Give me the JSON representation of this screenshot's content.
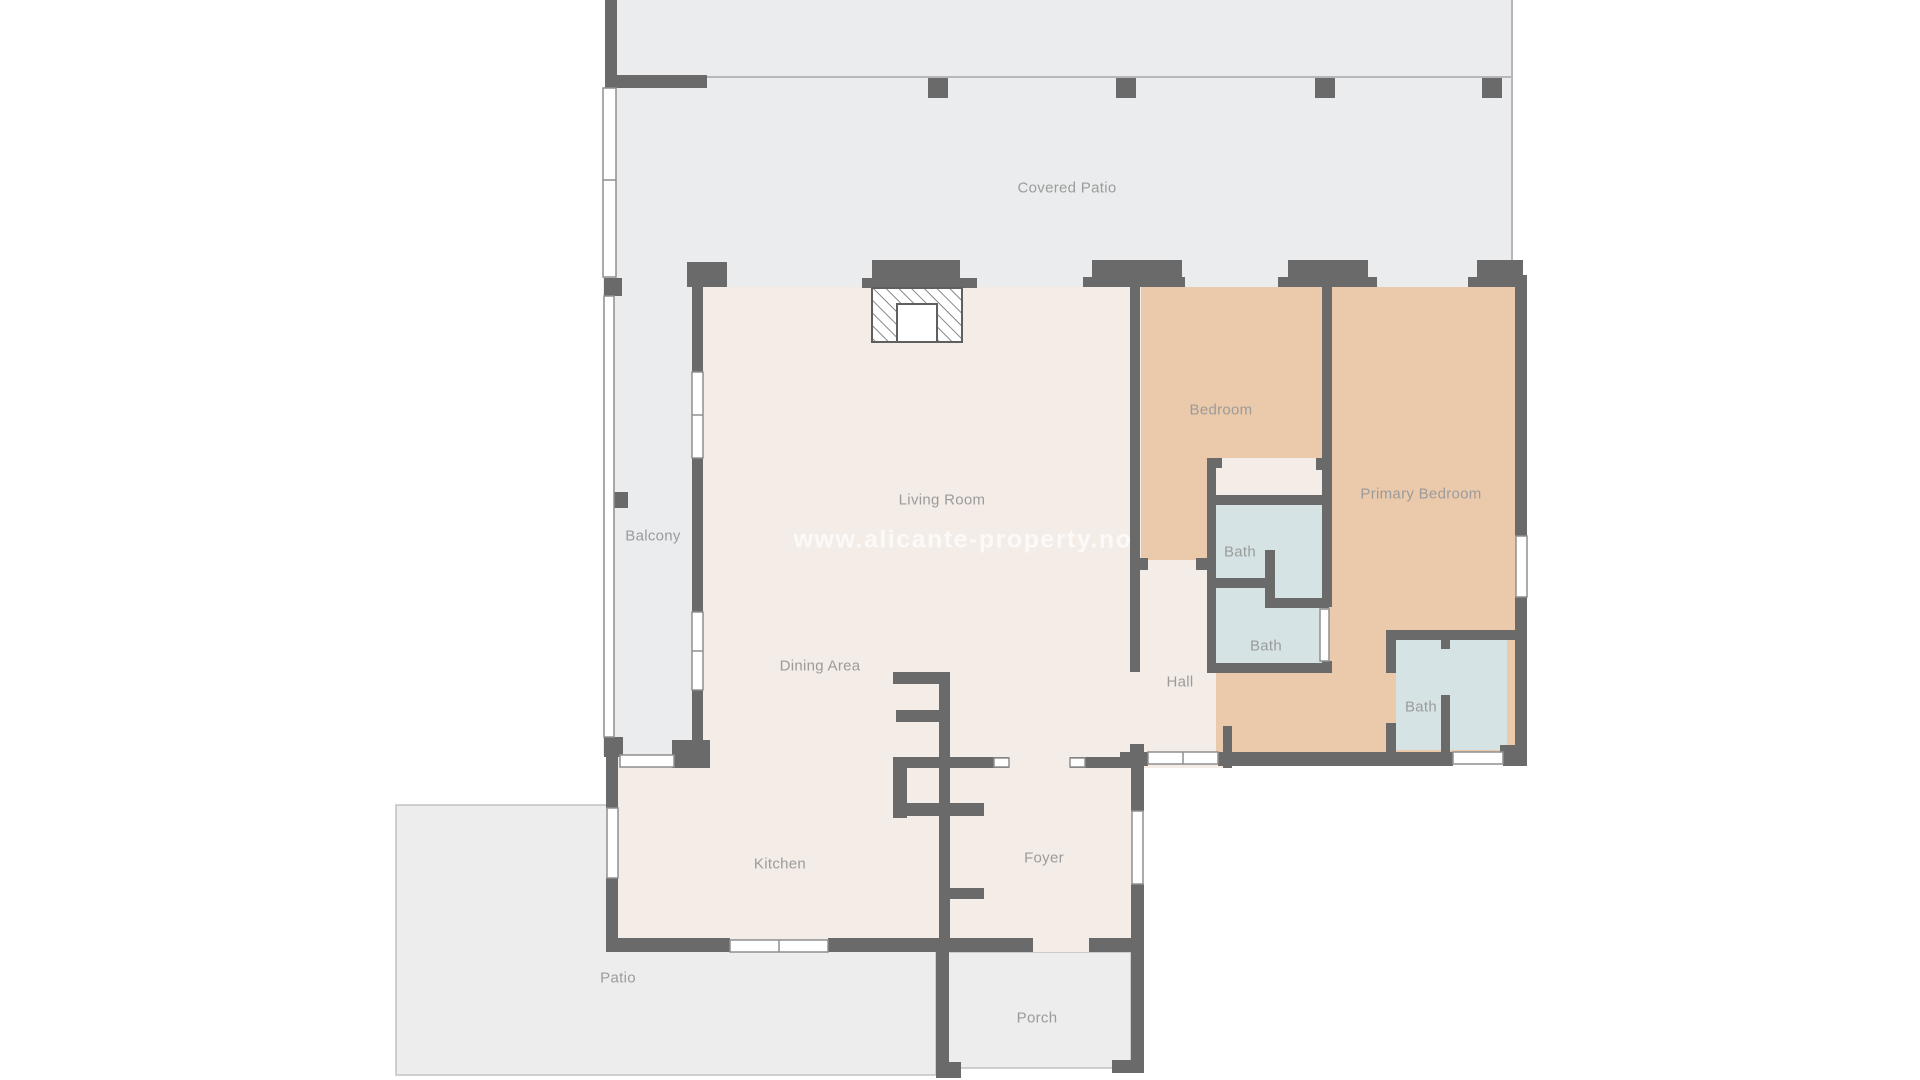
{
  "title": "Residential floor plan",
  "watermark": {
    "text": "www.alicante-property.no"
  },
  "rooms": [
    {
      "id": "covered-patio",
      "label": "Covered Patio"
    },
    {
      "id": "balcony",
      "label": "Balcony"
    },
    {
      "id": "living-room",
      "label": "Living Room"
    },
    {
      "id": "bedroom",
      "label": "Bedroom"
    },
    {
      "id": "primary-bedroom",
      "label": "Primary Bedroom"
    },
    {
      "id": "bath-upper",
      "label": "Bath"
    },
    {
      "id": "bath-middle",
      "label": "Bath"
    },
    {
      "id": "bath-lower",
      "label": "Bath"
    },
    {
      "id": "hall",
      "label": "Hall"
    },
    {
      "id": "dining-area",
      "label": "Dining Area"
    },
    {
      "id": "kitchen",
      "label": "Kitchen"
    },
    {
      "id": "foyer",
      "label": "Foyer"
    },
    {
      "id": "patio",
      "label": "Patio"
    },
    {
      "id": "porch",
      "label": "Porch"
    }
  ],
  "colors": {
    "bg": "#ffffff",
    "wall": "#6a6a6a",
    "patio": "#ebeced",
    "patio-open": "#ededee",
    "floor": "#f4ece6",
    "bedroom": "#ebc9ab",
    "bath": "#d6e3e4",
    "label": "#9b9b9b",
    "thin": "#c2c2c5",
    "window-stroke": "#8f8f8f"
  }
}
